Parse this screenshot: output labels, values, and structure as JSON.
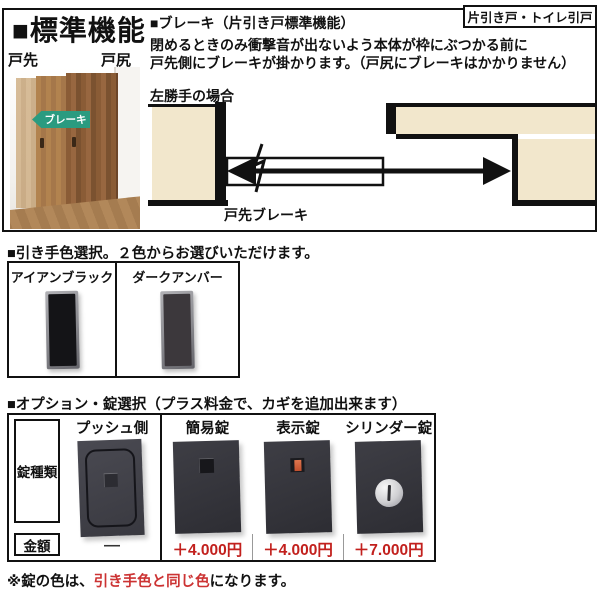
{
  "page": {
    "title": "■標準機能",
    "corner_tag": "片引き戸・トイレ引戸",
    "brake": {
      "heading": "■ブレーキ（片引き戸標準機能）",
      "desc_line1": "閉めるときのみ衝撃音が出ないよう本体が枠にぶつかる前に",
      "desc_line2": "戸先側にブレーキが掛かります。（戸尻にブレーキはかかりません）",
      "photo": {
        "label_left": "戸先",
        "label_right": "戸尻",
        "tag": "ブレーキ"
      },
      "diagram": {
        "caption": "左勝手の場合",
        "label": "戸先ブレーキ"
      }
    },
    "handle_section": {
      "heading": "■引き手色選択。２色からお選びいただけます。",
      "options": [
        {
          "name": "アイアンブラック"
        },
        {
          "name": "ダークアンバー"
        }
      ]
    },
    "lock_section": {
      "heading": "■オプション・錠選択（プラス料金で、カギを追加出来ます）",
      "row_labels": {
        "type": "錠種類",
        "price": "金額"
      },
      "columns": [
        {
          "name": "プッシュ側",
          "price": "―"
        },
        {
          "name": "簡易錠",
          "price": "＋4.000円"
        },
        {
          "name": "表示錠",
          "price": "＋4.000円"
        },
        {
          "name": "シリンダー錠",
          "price": "＋7.000円"
        }
      ]
    },
    "note": {
      "prefix": "※錠の色は、",
      "highlight": "引き手色と同じ色",
      "suffix": "になります。"
    },
    "colors": {
      "wall_beige": "#F2E7CC",
      "tag_green": "#2A9B80",
      "price_red": "#C2201D",
      "note_red": "#CC3333"
    }
  }
}
